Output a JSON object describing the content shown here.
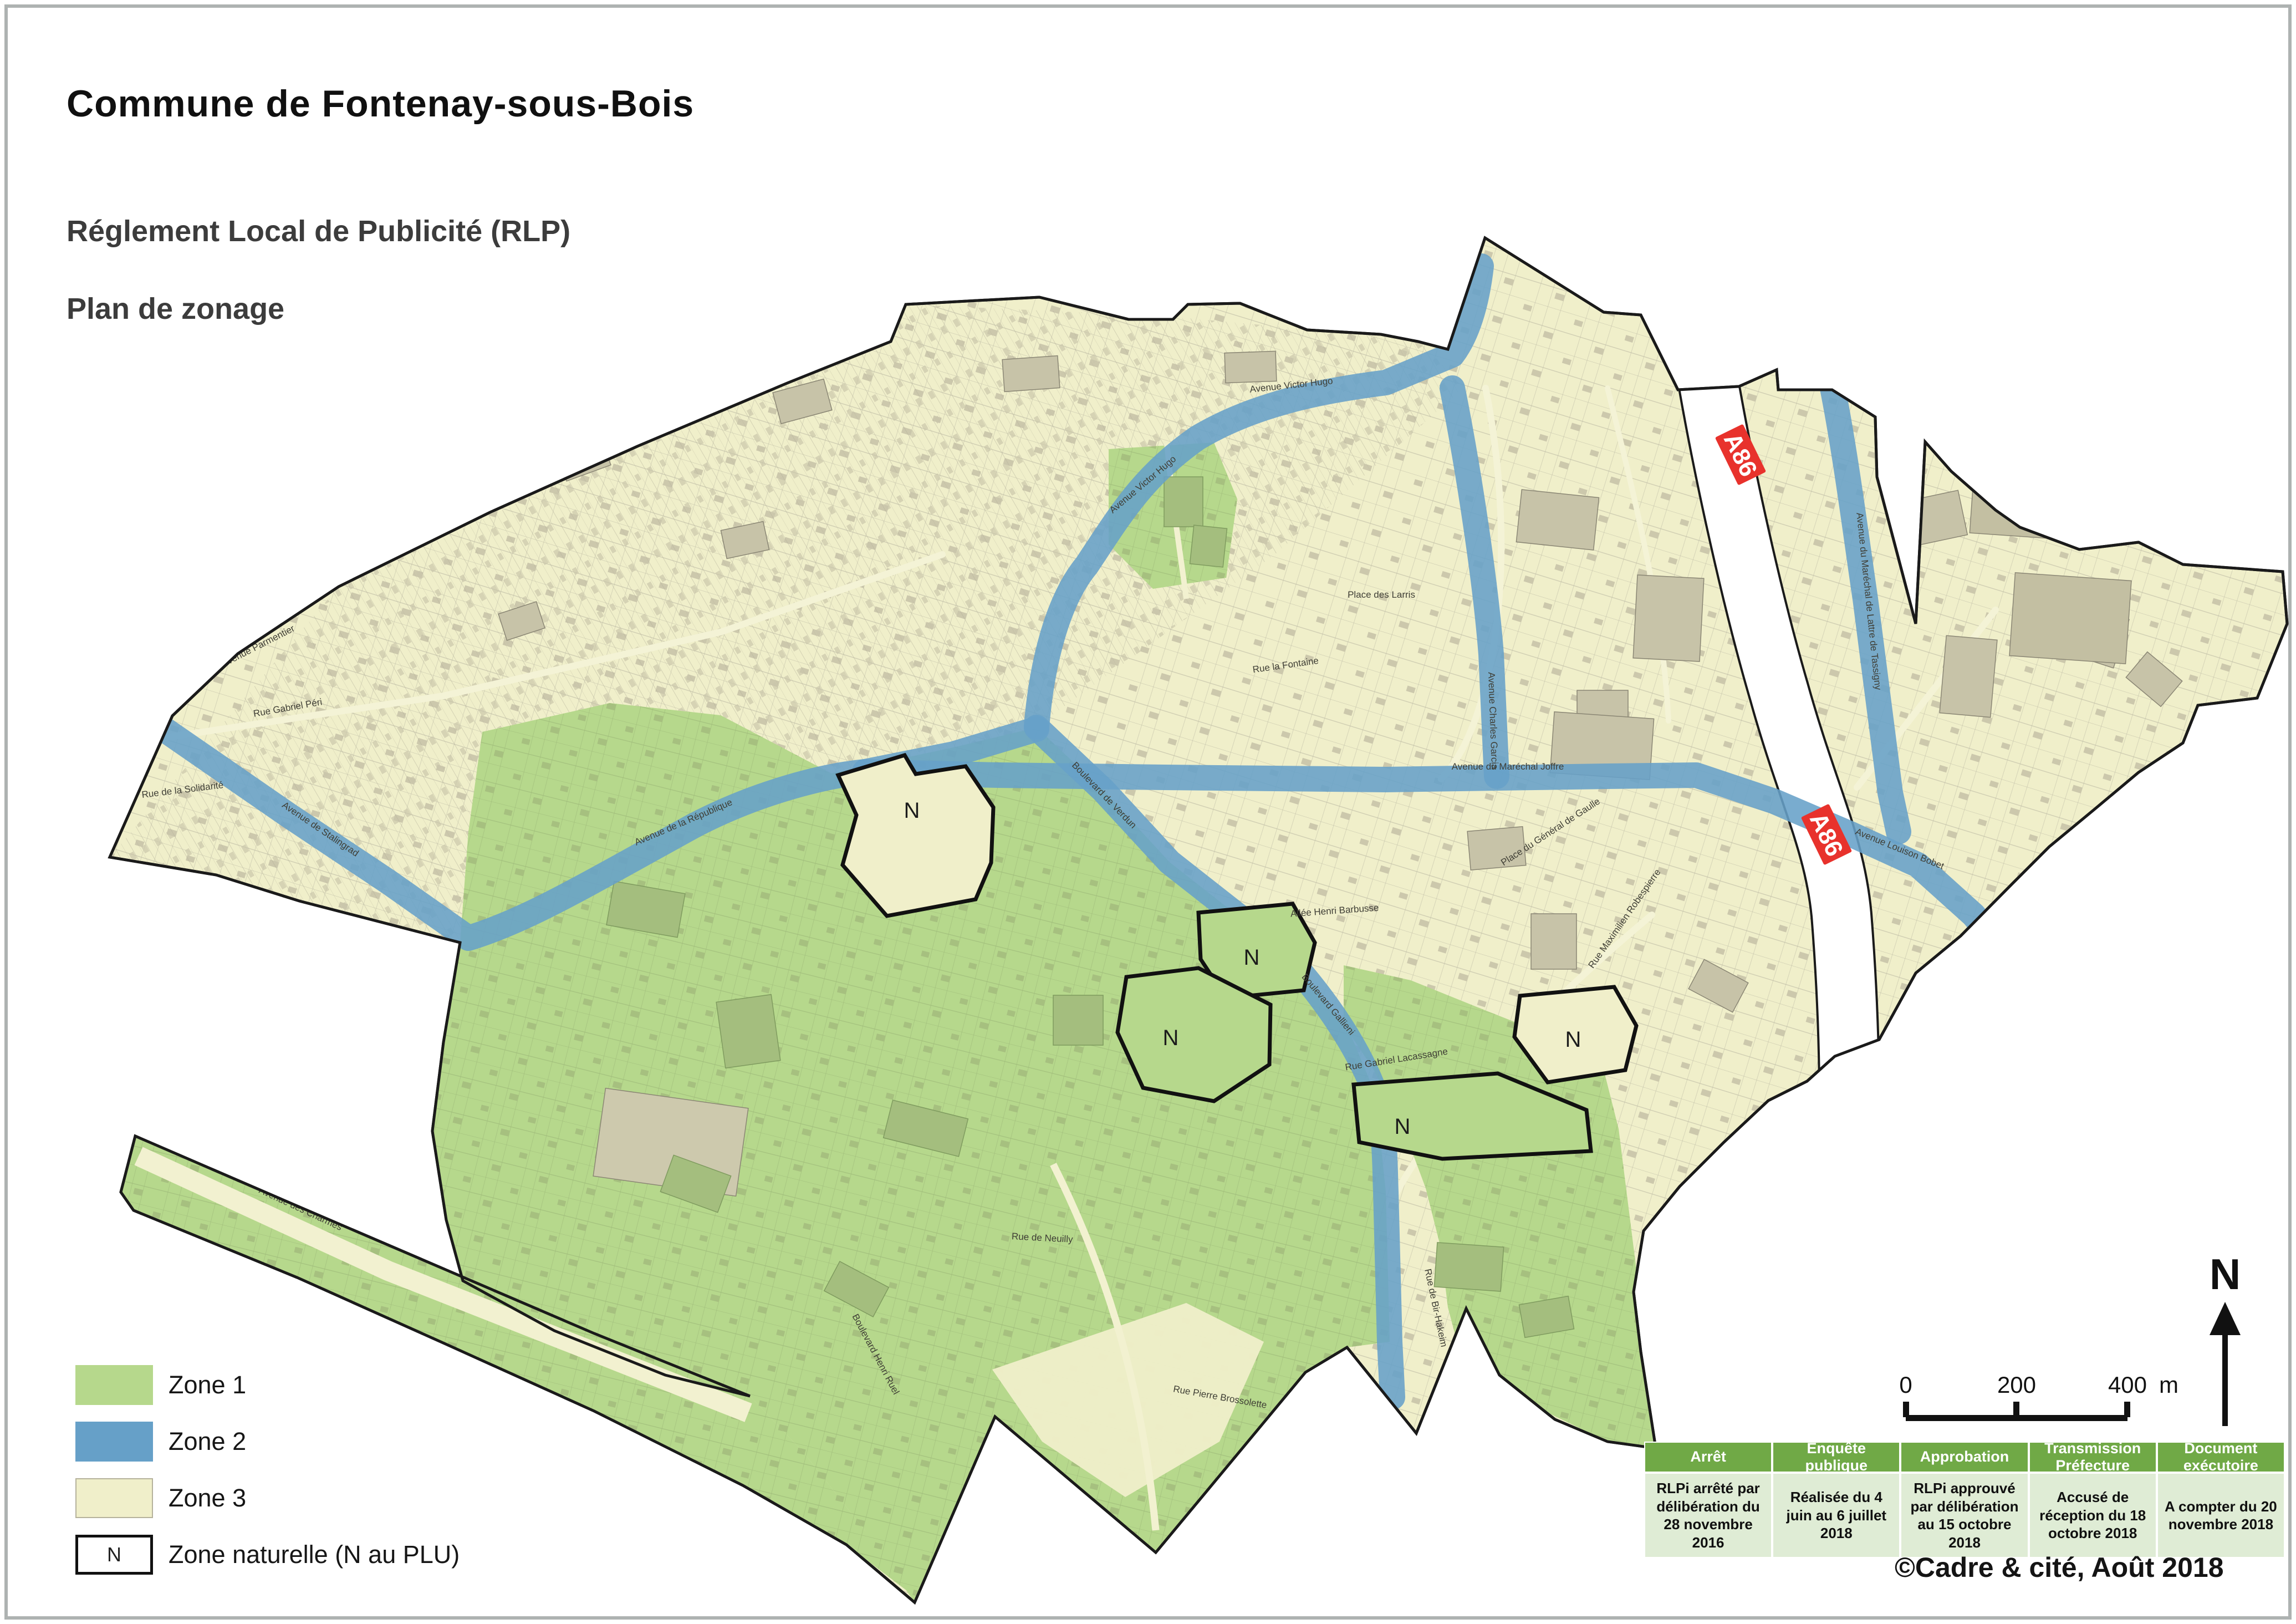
{
  "header": {
    "title": "Commune de Fontenay-sous-Bois",
    "subtitle": "Réglement Local de Publicité (RLP)",
    "plan_label": "Plan de zonage"
  },
  "legend": {
    "items": [
      {
        "label": "Zone 1",
        "color": "#b6d88c"
      },
      {
        "label": "Zone 2",
        "color": "#66a0c8"
      },
      {
        "label": "Zone 3",
        "color": "#f0efca"
      },
      {
        "label": "Zone naturelle (N au PLU)",
        "symbol": "N",
        "color": "#ffffff"
      }
    ]
  },
  "map": {
    "colors": {
      "zone1_green": "#b6d88c",
      "zone2_blue": "#66a0c8",
      "zone3_cream": "#f0efca",
      "boundary_black": "#1a1a1a",
      "highway_white": "#ffffff",
      "a86_badge_red": "#e8322c",
      "building_grey": "#c7c3a8"
    },
    "a86_badges": [
      {
        "label": "A86"
      },
      {
        "label": "A86"
      }
    ],
    "n_zones": [
      {
        "label": "N"
      },
      {
        "label": "N"
      },
      {
        "label": "N"
      },
      {
        "label": "N"
      },
      {
        "label": "N"
      }
    ],
    "streets": [
      {
        "text": "Avenue Victor Hugo"
      },
      {
        "text": "Avenue Victor Hugo"
      },
      {
        "text": "Avenue de Stalingrad"
      },
      {
        "text": "Avenue de la République"
      },
      {
        "text": "Boulevard de Verdun"
      },
      {
        "text": "Boulevard Gallieni"
      },
      {
        "text": "Avenue Louison Bobet"
      },
      {
        "text": "Avenue du Maréchal de Lattre de Tassigny"
      },
      {
        "text": "Avenue de la Belle Gabrielle"
      },
      {
        "text": "Avenue des Charmes"
      },
      {
        "text": "Avenue Foch"
      },
      {
        "text": "Rue de Neuilly"
      },
      {
        "text": "Rue la Fontaine"
      },
      {
        "text": "Rue Gabriel Péri"
      },
      {
        "text": "Avenue Parmentier"
      },
      {
        "text": "Place des Larris"
      },
      {
        "text": "Rue Gabriel Lacassagne"
      },
      {
        "text": "Allée Henri Barbusse"
      },
      {
        "text": "Rue Pierre Brossolette"
      },
      {
        "text": "Rue de la Solidarité"
      },
      {
        "text": "Boulevard Henri Ruel"
      },
      {
        "text": "Rue de Bir-Hakeim"
      },
      {
        "text": "Avenue du Maréchal Joffre"
      },
      {
        "text": "Avenue Charles Garcia"
      },
      {
        "text": "Place du Général de Gaulle"
      },
      {
        "text": "Rue Maximilien Robespierre"
      }
    ]
  },
  "scale_bar": {
    "ticks": [
      "0",
      "200",
      "400"
    ],
    "unit": "m"
  },
  "north": {
    "label": "N"
  },
  "approval_table": {
    "columns": [
      {
        "header": "Arrêt",
        "body": "RLPi arrêté par délibération du 28 novembre 2016"
      },
      {
        "header": "Enquête publique",
        "body": "Réalisée du 4 juin au 6 juillet 2018"
      },
      {
        "header": "Approbation",
        "body": "RLPi approuvé par délibération au 15 octobre 2018"
      },
      {
        "header": "Transmission Préfecture",
        "body": "Accusé de réception du 18 octobre 2018"
      },
      {
        "header": "Document exécutoire",
        "body": "A compter du 20 novembre 2018"
      }
    ]
  },
  "credit": "©Cadre & cité, Août 2018"
}
